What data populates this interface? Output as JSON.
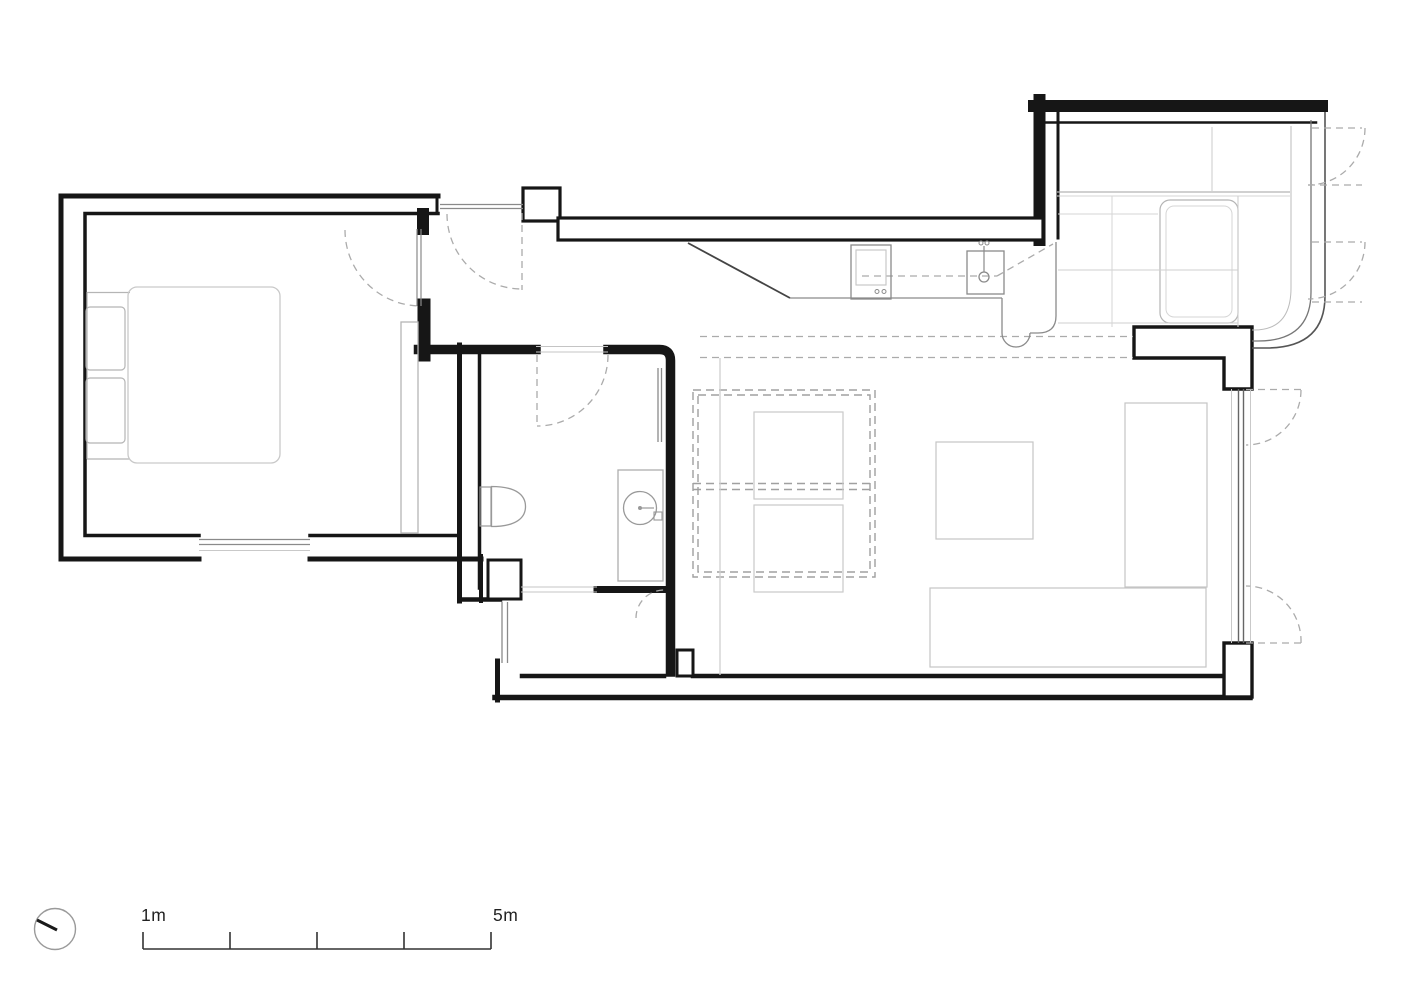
{
  "drawing": {
    "kind": "apartment-floor-plan",
    "scale_bar": {
      "label_start": "1m",
      "label_end": "5m",
      "tick_count": 5
    },
    "colors": {
      "background": "#ffffff",
      "wall_ink": "#161616",
      "dark_line": "#444444",
      "mid_gray": "#8a8a8a",
      "dash_gray": "#ababab",
      "furniture_gray": "#b5b5b5",
      "light_gray": "#c9c9c9",
      "faint_gray": "#d6d6d6"
    },
    "icons": {
      "north_indicator": "compass-circle-with-needle"
    }
  }
}
